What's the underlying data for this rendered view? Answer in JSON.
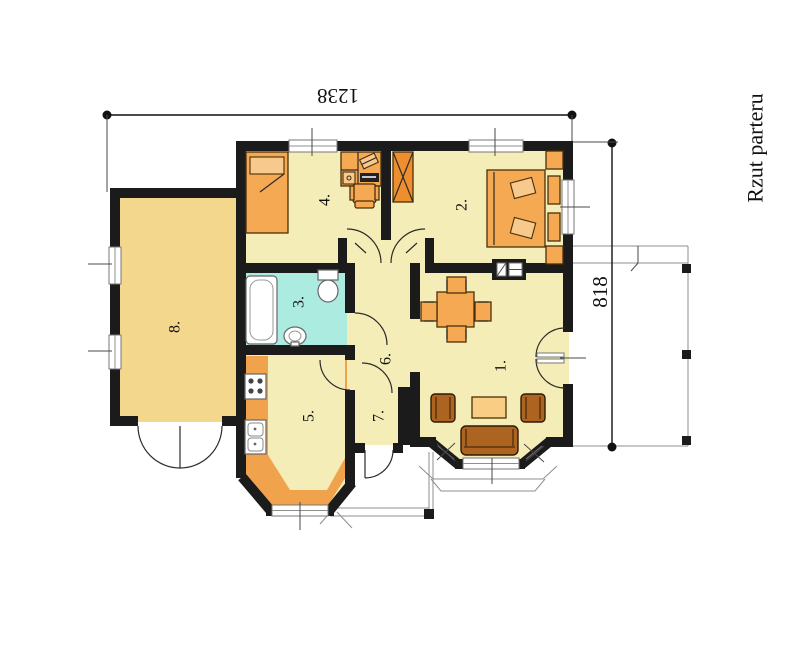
{
  "plan": {
    "title": "Rzut parteru",
    "width_dimension": "1238",
    "height_dimension": "818",
    "rooms": [
      {
        "label": "1."
      },
      {
        "label": "2."
      },
      {
        "label": "3."
      },
      {
        "label": "4."
      },
      {
        "label": "5."
      },
      {
        "label": "6."
      },
      {
        "label": "7."
      },
      {
        "label": "8."
      }
    ],
    "colors": {
      "wall": "#1b1b1b",
      "room_fill": "#F5EDB7",
      "garage_fill": "#F3D78C",
      "counter_fill": "#F0A24C",
      "furniture_orange": "#F5A952",
      "furniture_light": "#F8C98C",
      "wardrobe_orange": "#EE8E2E",
      "coffee_table": "#FACD84",
      "sofa_brown": "#AC6420",
      "bathroom_fill": "#ACEBDF",
      "fixture_white": "#FFFFFF"
    }
  }
}
